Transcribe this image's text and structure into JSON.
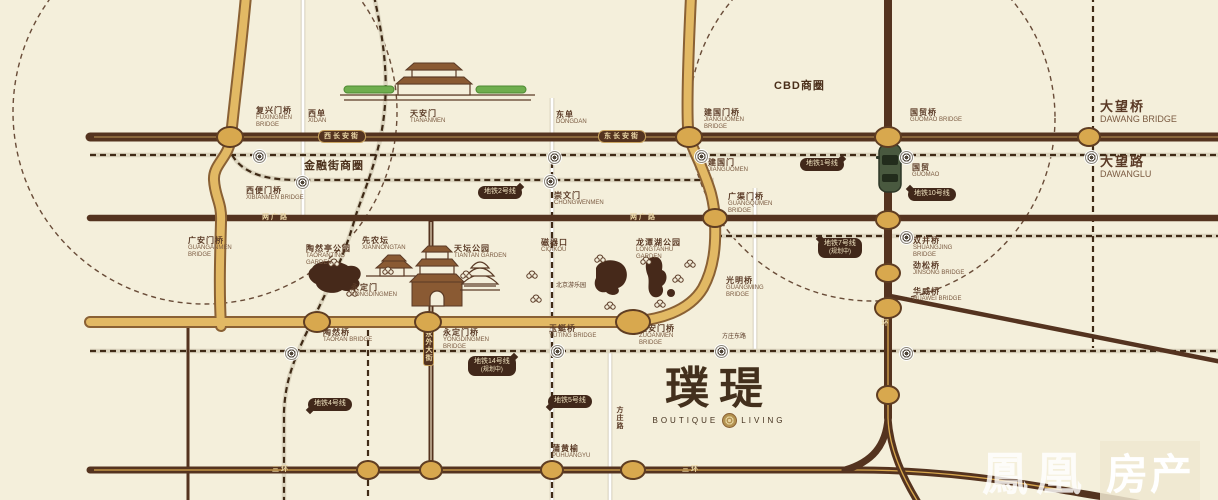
{
  "colors": {
    "bg": "#f4efdb",
    "road_dark": "#54331f",
    "gold": "#e2b964",
    "gold_edge": "#8a6134",
    "band": "#dcd5bf",
    "dash": "#3f2a16",
    "node": "#d8a84e",
    "node_ring": "#5f3d22",
    "label": "#5a3a26",
    "cream": "#ecd9a8",
    "callout_bg": "#41281a",
    "callout_text": "#f0e3c0"
  },
  "map": {
    "areas": [
      {
        "text": "金融街商圈",
        "x": 304,
        "y": 160
      },
      {
        "text": "CBD商圈",
        "x": 774,
        "y": 80
      }
    ],
    "bridges": [
      {
        "zh": "复兴门桥",
        "en": "FUXINGMEN BRIDGE",
        "x": 256,
        "y": 106
      },
      {
        "zh": "西单",
        "en": "XIDAN",
        "x": 308,
        "y": 109
      },
      {
        "zh": "天安门",
        "en": "TIANANMEN",
        "x": 410,
        "y": 109
      },
      {
        "zh": "东单",
        "en": "DONGDAN",
        "x": 556,
        "y": 110
      },
      {
        "zh": "建国门桥",
        "en": "JIANGUOMEN BRIDGE",
        "x": 704,
        "y": 108
      },
      {
        "zh": "国贸桥",
        "en": "GUOMAO BRIDGE",
        "x": 910,
        "y": 108
      },
      {
        "zh": "大望桥",
        "en": "DAWANG BRIDGE",
        "x": 1100,
        "y": 100,
        "big": true
      },
      {
        "zh": "大望路",
        "en": "DAWANGLU",
        "x": 1100,
        "y": 155,
        "big": true
      },
      {
        "zh": "建国门",
        "en": "JIANGUOMEN",
        "x": 708,
        "y": 158
      },
      {
        "zh": "国贸",
        "en": "GUOMAO",
        "x": 912,
        "y": 163
      },
      {
        "zh": "西便门桥",
        "en": "XIBIANMEN BRIDGE",
        "x": 246,
        "y": 186
      },
      {
        "zh": "广安门桥",
        "en": "GUANGANMEN BRIDGE",
        "x": 188,
        "y": 236
      },
      {
        "zh": "崇文门",
        "en": "CHONGWENMEN",
        "x": 554,
        "y": 191
      },
      {
        "zh": "磁器口",
        "en": "CIQIKOU",
        "x": 541,
        "y": 238
      },
      {
        "zh": "广渠门桥",
        "en": "GUANGQUMEN BRIDGE",
        "x": 728,
        "y": 192
      },
      {
        "zh": "双井桥",
        "en": "SHUANGJING BRIDGE",
        "x": 913,
        "y": 236
      },
      {
        "zh": "劲松桥",
        "en": "JINSONG BRIDGE",
        "x": 913,
        "y": 261
      },
      {
        "zh": "华威桥",
        "en": "HUAWEI BRIDGE",
        "x": 913,
        "y": 287
      },
      {
        "zh": "光明桥",
        "en": "GUANGMING BRIDGE",
        "x": 726,
        "y": 276
      },
      {
        "zh": "左安门桥",
        "en": "ZUOANMEN BRIDGE",
        "x": 639,
        "y": 324
      },
      {
        "zh": "玉蜓桥",
        "en": "YUTING BRIDGE",
        "x": 549,
        "y": 324
      },
      {
        "zh": "陶然桥",
        "en": "TAORAN BRIDGE",
        "x": 323,
        "y": 328
      },
      {
        "zh": "永定门桥",
        "en": "YONGDINGMEN BRIDGE",
        "x": 443,
        "y": 328
      },
      {
        "zh": "蒲黄榆",
        "en": "PUHUANGYU",
        "x": 552,
        "y": 444
      }
    ],
    "parks": [
      {
        "zh": "陶然亭公园",
        "en": "TAORANTING GARDEN",
        "x": 306,
        "y": 244
      },
      {
        "zh": "先农坛",
        "en": "XIANNONGTAN",
        "x": 362,
        "y": 236
      },
      {
        "zh": "天坛公园",
        "en": "TIANTAN GARDEN",
        "x": 454,
        "y": 244
      },
      {
        "zh": "永定门",
        "en": "YONGDINGMEN",
        "x": 351,
        "y": 283
      },
      {
        "zh": "龙潭湖公园",
        "en": "LONGTANHU GARDEN",
        "x": 636,
        "y": 238
      }
    ],
    "road_names": [
      {
        "text": "西长安街",
        "x": 318,
        "y": 130,
        "plate": true
      },
      {
        "text": "东长安街",
        "x": 598,
        "y": 130,
        "plate": true
      },
      {
        "text": "两广路",
        "x": 262,
        "y": 214
      },
      {
        "text": "两广路",
        "x": 630,
        "y": 214
      },
      {
        "text": "三环",
        "x": 272,
        "y": 466
      },
      {
        "text": "三环",
        "x": 682,
        "y": 466
      },
      {
        "text": "东三环",
        "x": 881,
        "y": 303,
        "vertical": true
      },
      {
        "text": "永外大街",
        "x": 423,
        "y": 326,
        "vertical": true,
        "plate": true
      },
      {
        "text": "方庄路",
        "x": 616,
        "y": 406,
        "vertical": true,
        "dark": true
      }
    ],
    "notes": [
      {
        "text": "北京游乐园",
        "x": 556,
        "y": 280
      },
      {
        "text": "方庄东路",
        "x": 722,
        "y": 331
      }
    ],
    "callouts": [
      {
        "text": "地铁1号线",
        "x": 800,
        "y": 158,
        "tail": "rt"
      },
      {
        "text": "地铁2号线",
        "x": 478,
        "y": 186,
        "tail": "rt"
      },
      {
        "text": "地铁10号线",
        "x": 908,
        "y": 188,
        "tail": "lt"
      },
      {
        "text": "地铁7号线",
        "sub": "(规划中)",
        "x": 818,
        "y": 238,
        "tail": "lt"
      },
      {
        "text": "地铁14号线",
        "sub": "(规划中)",
        "x": 468,
        "y": 356,
        "tail": "rt"
      },
      {
        "text": "地铁4号线",
        "x": 308,
        "y": 398,
        "tail": "lb"
      },
      {
        "text": "地铁5号线",
        "x": 548,
        "y": 395,
        "tail": "lb"
      }
    ],
    "stations": [
      {
        "x": 258,
        "y": 155
      },
      {
        "x": 553,
        "y": 156
      },
      {
        "x": 700,
        "y": 155
      },
      {
        "x": 905,
        "y": 156
      },
      {
        "x": 1090,
        "y": 156
      },
      {
        "x": 301,
        "y": 181
      },
      {
        "x": 549,
        "y": 180
      },
      {
        "x": 905,
        "y": 236
      },
      {
        "x": 290,
        "y": 352
      },
      {
        "x": 556,
        "y": 350
      },
      {
        "x": 720,
        "y": 350
      },
      {
        "x": 905,
        "y": 352
      }
    ],
    "junctions": [
      {
        "x": 230,
        "y": 137,
        "rx": 12,
        "ry": 9
      },
      {
        "x": 689,
        "y": 137,
        "rx": 12,
        "ry": 9
      },
      {
        "x": 888,
        "y": 137,
        "rx": 12,
        "ry": 9
      },
      {
        "x": 1089,
        "y": 137,
        "rx": 10,
        "ry": 8
      },
      {
        "x": 715,
        "y": 218,
        "rx": 11,
        "ry": 8
      },
      {
        "x": 888,
        "y": 220,
        "rx": 11,
        "ry": 8
      },
      {
        "x": 888,
        "y": 273,
        "rx": 11,
        "ry": 8
      },
      {
        "x": 888,
        "y": 308,
        "rx": 12,
        "ry": 9
      },
      {
        "x": 888,
        "y": 395,
        "rx": 10,
        "ry": 8
      },
      {
        "x": 317,
        "y": 322,
        "rx": 12,
        "ry": 9
      },
      {
        "x": 428,
        "y": 322,
        "rx": 12,
        "ry": 9
      },
      {
        "x": 633,
        "y": 322,
        "rx": 16,
        "ry": 11
      },
      {
        "x": 368,
        "y": 470,
        "rx": 10,
        "ry": 8
      },
      {
        "x": 431,
        "y": 470,
        "rx": 10,
        "ry": 8
      },
      {
        "x": 552,
        "y": 470,
        "rx": 10,
        "ry": 8
      },
      {
        "x": 633,
        "y": 470,
        "rx": 11,
        "ry": 8
      }
    ],
    "logo": {
      "zh": "璞瑅",
      "en_left": "BOUTIQUE",
      "en_right": "LIVING"
    },
    "watermark": {
      "part1": "鳳凰",
      "part2": "房产"
    }
  }
}
